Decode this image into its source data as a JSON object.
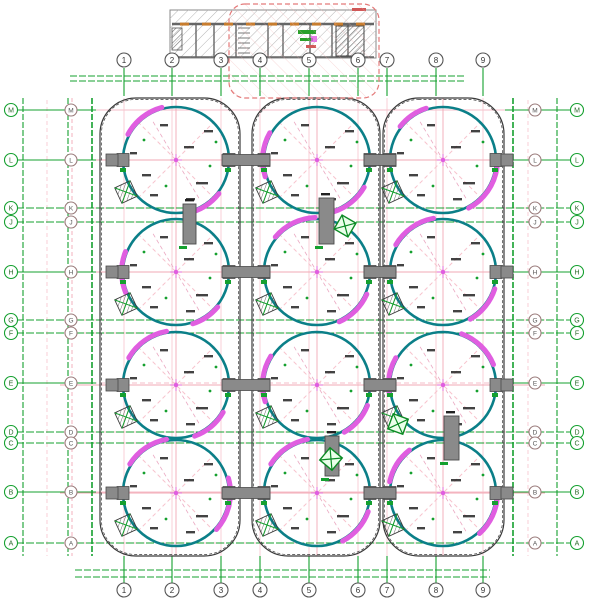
{
  "drawing": {
    "name": "tank-farm-plan-cad-drawing",
    "colors": {
      "green": "#15a02f",
      "green_dark": "#0b8a24",
      "teal": "#0b7f88",
      "pink": "#f2a9b6",
      "pink_light": "#f7c3cd",
      "magenta": "#e05ee0",
      "red_dashed": "#e47a7a",
      "gray_node": "#8a8a8a",
      "gray_dark": "#4a4a4a",
      "wall_black": "#3a3a3a",
      "hatch_gray": "#b5b5b5"
    },
    "grid_cols": [
      {
        "label": "1",
        "x": 124
      },
      {
        "label": "2",
        "x": 172
      },
      {
        "label": "3",
        "x": 221
      },
      {
        "label": "4",
        "x": 260
      },
      {
        "label": "5",
        "x": 309
      },
      {
        "label": "6",
        "x": 358
      },
      {
        "label": "7",
        "x": 387
      },
      {
        "label": "8",
        "x": 436
      },
      {
        "label": "9",
        "x": 483
      }
    ],
    "grid_rows": [
      {
        "label": "M",
        "y": 110,
        "full": false
      },
      {
        "label": "L",
        "y": 160,
        "full": false
      },
      {
        "label": "K",
        "y": 208,
        "full": true
      },
      {
        "label": "J",
        "y": 222,
        "full": true
      },
      {
        "label": "H",
        "y": 272,
        "full": false
      },
      {
        "label": "G",
        "y": 320,
        "full": true
      },
      {
        "label": "F",
        "y": 333,
        "full": true
      },
      {
        "label": "E",
        "y": 383,
        "full": false
      },
      {
        "label": "D",
        "y": 432,
        "full": true
      },
      {
        "label": "C",
        "y": 443,
        "full": true
      },
      {
        "label": "B",
        "y": 492,
        "full": false
      },
      {
        "label": "A",
        "y": 543,
        "full": true
      }
    ],
    "tanks": {
      "cols_x": [
        176,
        317,
        443
      ],
      "rows_y": [
        160,
        272,
        385,
        493
      ],
      "radius": 53,
      "arcs": [
        [
          [
            105,
            152
          ],
          [
            -38,
            -78
          ]
        ],
        [
          [
            150,
            198
          ],
          [
            -30,
            -72
          ]
        ],
        [
          [
            108,
            142
          ],
          [
            -8,
            -62
          ]
        ],
        [
          [
            158,
            202
          ],
          [
            -40,
            -72
          ]
        ],
        [
          [
            92,
            140
          ],
          [
            -24,
            -66
          ]
        ],
        [
          [
            100,
            150
          ],
          [
            -18,
            -60
          ]
        ],
        [
          [
            100,
            150
          ],
          [
            -30,
            -70
          ]
        ],
        [
          [
            148,
            198
          ],
          [
            -22,
            -60
          ]
        ],
        [
          [
            22,
            70
          ],
          [
            150,
            188
          ]
        ],
        [
          [
            100,
            148
          ],
          [
            16,
            -42
          ]
        ],
        [
          [
            100,
            148
          ],
          [
            -20,
            -62
          ]
        ],
        [
          [
            128,
            168
          ],
          [
            -2,
            -48
          ]
        ]
      ]
    },
    "enclosures": [
      {
        "x": 100,
        "y": 98,
        "w": 140,
        "h": 458,
        "r": 36
      },
      {
        "x": 252,
        "y": 98,
        "w": 128,
        "h": 458,
        "r": 36
      },
      {
        "x": 383,
        "y": 98,
        "w": 121,
        "h": 458,
        "r": 36
      }
    ],
    "bridge_gaps": [
      {
        "x": 222,
        "w": 48
      },
      {
        "x": 364,
        "w": 32
      }
    ],
    "connectors": [
      {
        "x": 183,
        "y": 204,
        "w": 13,
        "h": 40
      },
      {
        "x": 319,
        "y": 198,
        "w": 15,
        "h": 46
      },
      {
        "x": 325,
        "y": 436,
        "w": 14,
        "h": 40
      },
      {
        "x": 444,
        "y": 416,
        "w": 15,
        "h": 44
      }
    ],
    "equipment": [
      {
        "x": 345,
        "y": 226,
        "rot": 30
      },
      {
        "x": 398,
        "y": 424,
        "rot": 20
      },
      {
        "x": 331,
        "y": 459,
        "rot": 40
      }
    ],
    "pump_house": {
      "x": 170,
      "y": 10,
      "w": 206,
      "h": 48,
      "red_zone": {
        "x": 229,
        "y": 4,
        "w": 150,
        "h": 94
      }
    }
  }
}
